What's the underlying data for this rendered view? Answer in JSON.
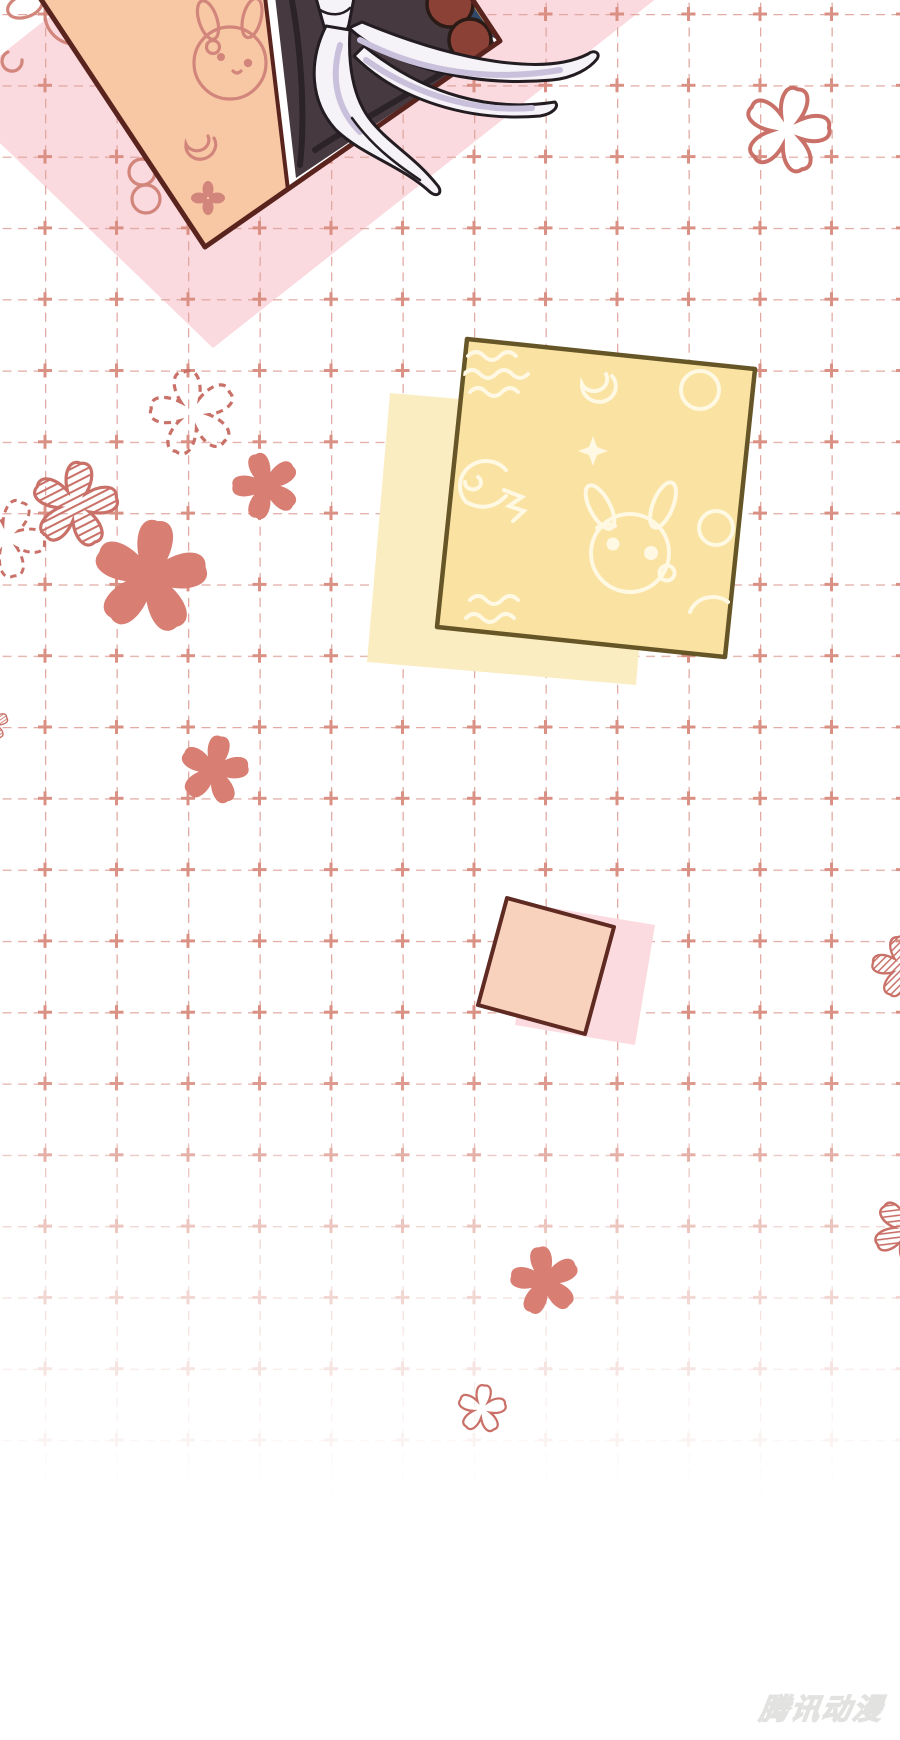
{
  "page": {
    "width": 900,
    "height": 1740,
    "kind": "comic-transition-page"
  },
  "watermark": {
    "text": "腾讯动漫"
  },
  "grid": {
    "step_x": 71.5,
    "step_y": 71.3,
    "offset_x": 45,
    "offset_y": 14,
    "style": "dashed",
    "fade_from_y": 1050,
    "fade_to_y": 1500
  },
  "colors": {
    "pink-backdrop": "#fad9df",
    "grid-line": "#dfa49b",
    "grid-cross": "#d98c80",
    "flower-solid": "#d87e72",
    "flower-line": "#c97168",
    "panel-border": "#5a241e",
    "peach": "#f8c8a5",
    "doodle-rose": "#d2857b",
    "dark-cloth": "#463a40",
    "dark-crease": "#2b2328",
    "patch-navy": "#31486b",
    "patch-teal": "#85bdc8",
    "patch-red": "#b5433c",
    "patch-tan": "#c9a15c",
    "bun-brown": "#8c4136",
    "bun-outline": "#2b1b17",
    "tassel-white": "#f5f3f8",
    "tassel-shadow": "#c9c1db",
    "tassel-outline": "#231c21",
    "note-yellow": "#fae3a2",
    "note-yellow-back": "#fbedc2",
    "note-yellow-border": "#665627",
    "note-doodle": "#fff8e2",
    "note-pink": "#f9d2be",
    "note-pink-back": "#fbdbe0",
    "note-pink-border": "#5e2a22",
    "watermark": "#dededc"
  },
  "decorations": {
    "flowers": [
      {
        "name": "outline-flower-top-right",
        "style": "outline",
        "x": 787,
        "y": 130,
        "scale": 1.0,
        "rotate": 15
      },
      {
        "name": "dashed-sketch-flower",
        "style": "dashed",
        "x": 193,
        "y": 413,
        "scale": 1.0,
        "rotate": -12
      },
      {
        "name": "hatch-flower-left",
        "style": "hatch",
        "x": 75,
        "y": 505,
        "scale": 1.0,
        "rotate": 8
      },
      {
        "name": "dashed-flower-left-edge",
        "style": "dashed",
        "x": 6,
        "y": 538,
        "scale": 0.92,
        "rotate": 24
      },
      {
        "name": "solid-flower-large",
        "style": "solid",
        "x": 150,
        "y": 577,
        "scale": 1.32,
        "rotate": 8
      },
      {
        "name": "solid-flower-small-upper",
        "style": "solid",
        "x": 266,
        "y": 486,
        "scale": 0.78,
        "rotate": -18
      },
      {
        "name": "solid-flower-mid-left",
        "style": "solid",
        "x": 214,
        "y": 770,
        "scale": 0.8,
        "rotate": 12
      },
      {
        "name": "hatch-flower-left-edge",
        "style": "hatch",
        "x": -10,
        "y": 723,
        "scale": 0.42,
        "rotate": 0
      },
      {
        "name": "hatch-flower-right-edge",
        "style": "hatch",
        "x": 903,
        "y": 967,
        "scale": 0.72,
        "rotate": -10
      },
      {
        "name": "hatch-flower-right-edge-2",
        "style": "hatch",
        "x": 907,
        "y": 1230,
        "scale": 0.78,
        "rotate": 28
      },
      {
        "name": "solid-flower-bottom",
        "style": "solid",
        "x": 545,
        "y": 1281,
        "scale": 0.8,
        "rotate": -10
      },
      {
        "name": "outline-flower-bottom",
        "style": "outline",
        "x": 482,
        "y": 1409,
        "scale": 0.56,
        "rotate": 6
      }
    ]
  }
}
